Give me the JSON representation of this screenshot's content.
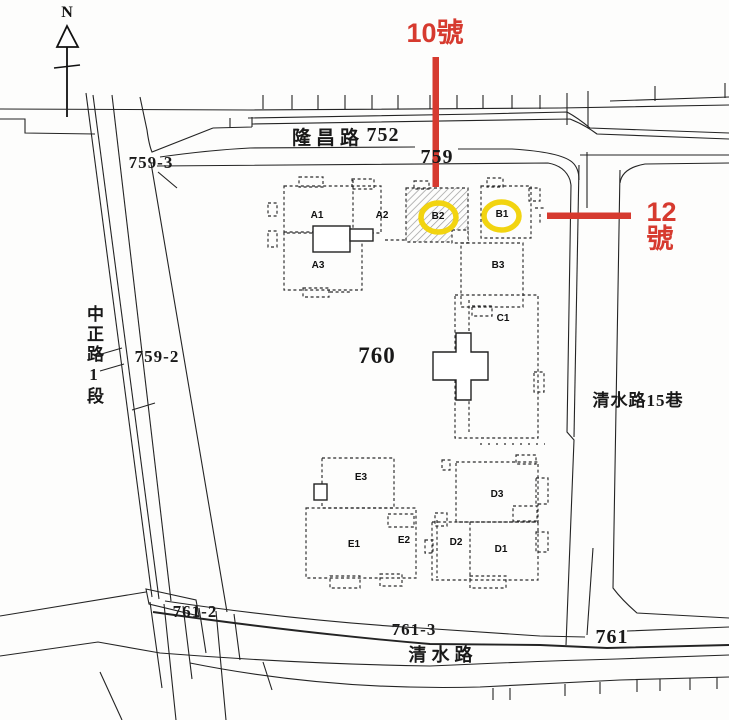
{
  "map": {
    "compass_label": "N",
    "roads": {
      "longchang": "隆昌路",
      "zhongzheng": "中正路1段",
      "qingshui_lane15": "清水路15巷",
      "qingshui": "清水路"
    },
    "parcels": {
      "p752": "752",
      "p759": "759",
      "p759_2": "759-2",
      "p759_3": "759-3",
      "p760": "760",
      "p761": "761",
      "p761_2": "761-2",
      "p761_3": "761-3"
    },
    "buildings": {
      "a1": "A1",
      "a2": "A2",
      "a3": "A3",
      "b1": "B1",
      "b2": "B2",
      "b3": "B3",
      "c1": "C1",
      "d1": "D1",
      "d2": "D2",
      "d3": "D3",
      "e1": "E1",
      "e2": "E2",
      "e3": "E3"
    }
  },
  "annotations": {
    "house10": {
      "label": "10號"
    },
    "house12": {
      "label": "12號"
    },
    "callout_color": "#d63a2f",
    "highlight_color": "#f2d410",
    "highlighted_buildings": [
      "B2",
      "B1"
    ],
    "line_color_black": "#222222"
  }
}
